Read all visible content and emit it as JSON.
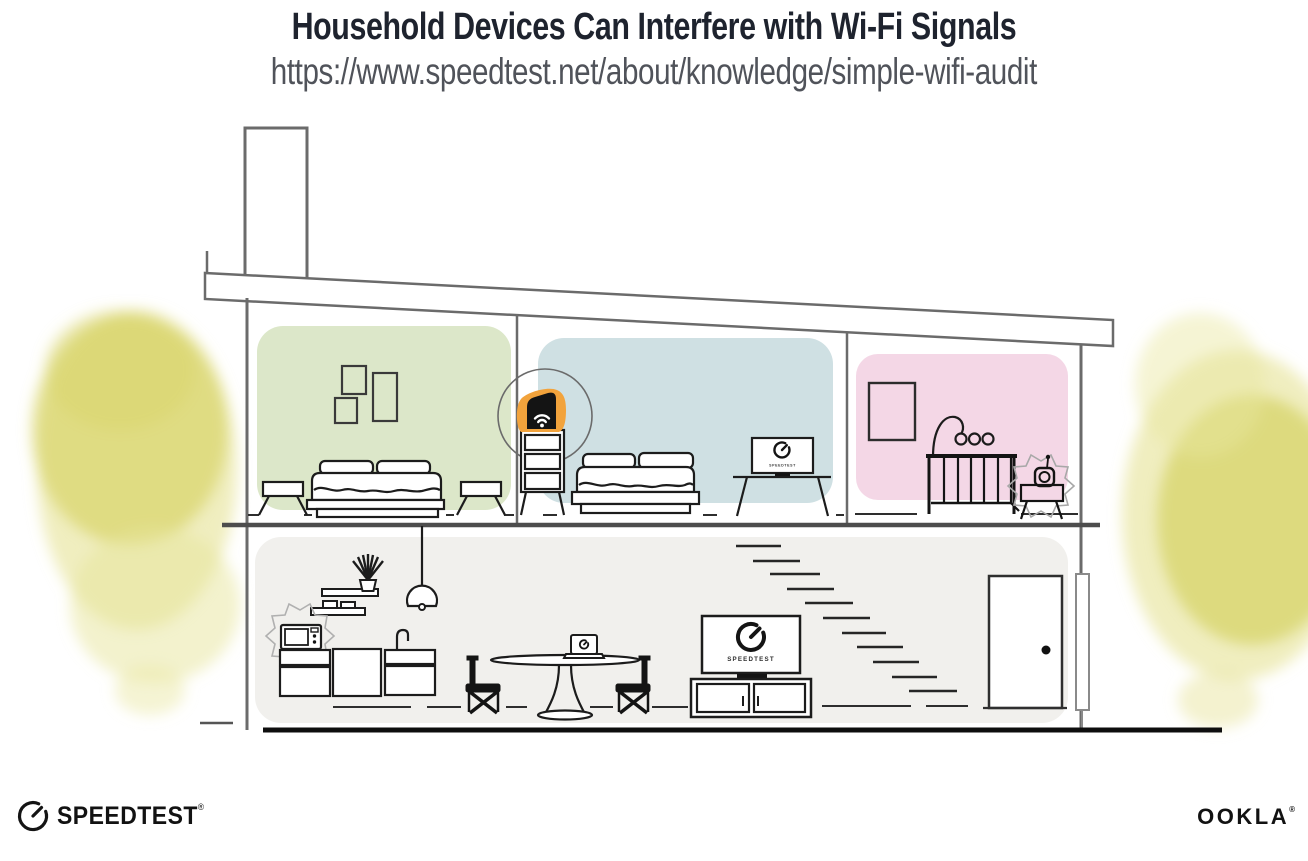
{
  "header": {
    "title": "Household Devices Can Interfere with Wi-Fi Signals",
    "url": "https://www.speedtest.net/about/knowledge/simple-wifi-audit"
  },
  "illustration": {
    "bedroom_tv_label": "SPEEDTEST",
    "living_room_tv_label": "SPEEDTEST",
    "colors": {
      "accent_orange": "#F2A33C",
      "bedroom_green": "#DCE7C9",
      "bedroom_blue": "#CFE0E3",
      "nursery_pink": "#F4D7E6",
      "downstairs_gray": "#F1F0ED",
      "foliage_yellow": "#DFDC7C",
      "structure_gray": "#6B6B6B",
      "ink_black": "#1A1A1A"
    }
  },
  "footer": {
    "speedtest_wordmark": "SPEEDTEST",
    "speedtest_trademark": "®",
    "ookla_wordmark": "OOKLA",
    "ookla_trademark": "®"
  }
}
